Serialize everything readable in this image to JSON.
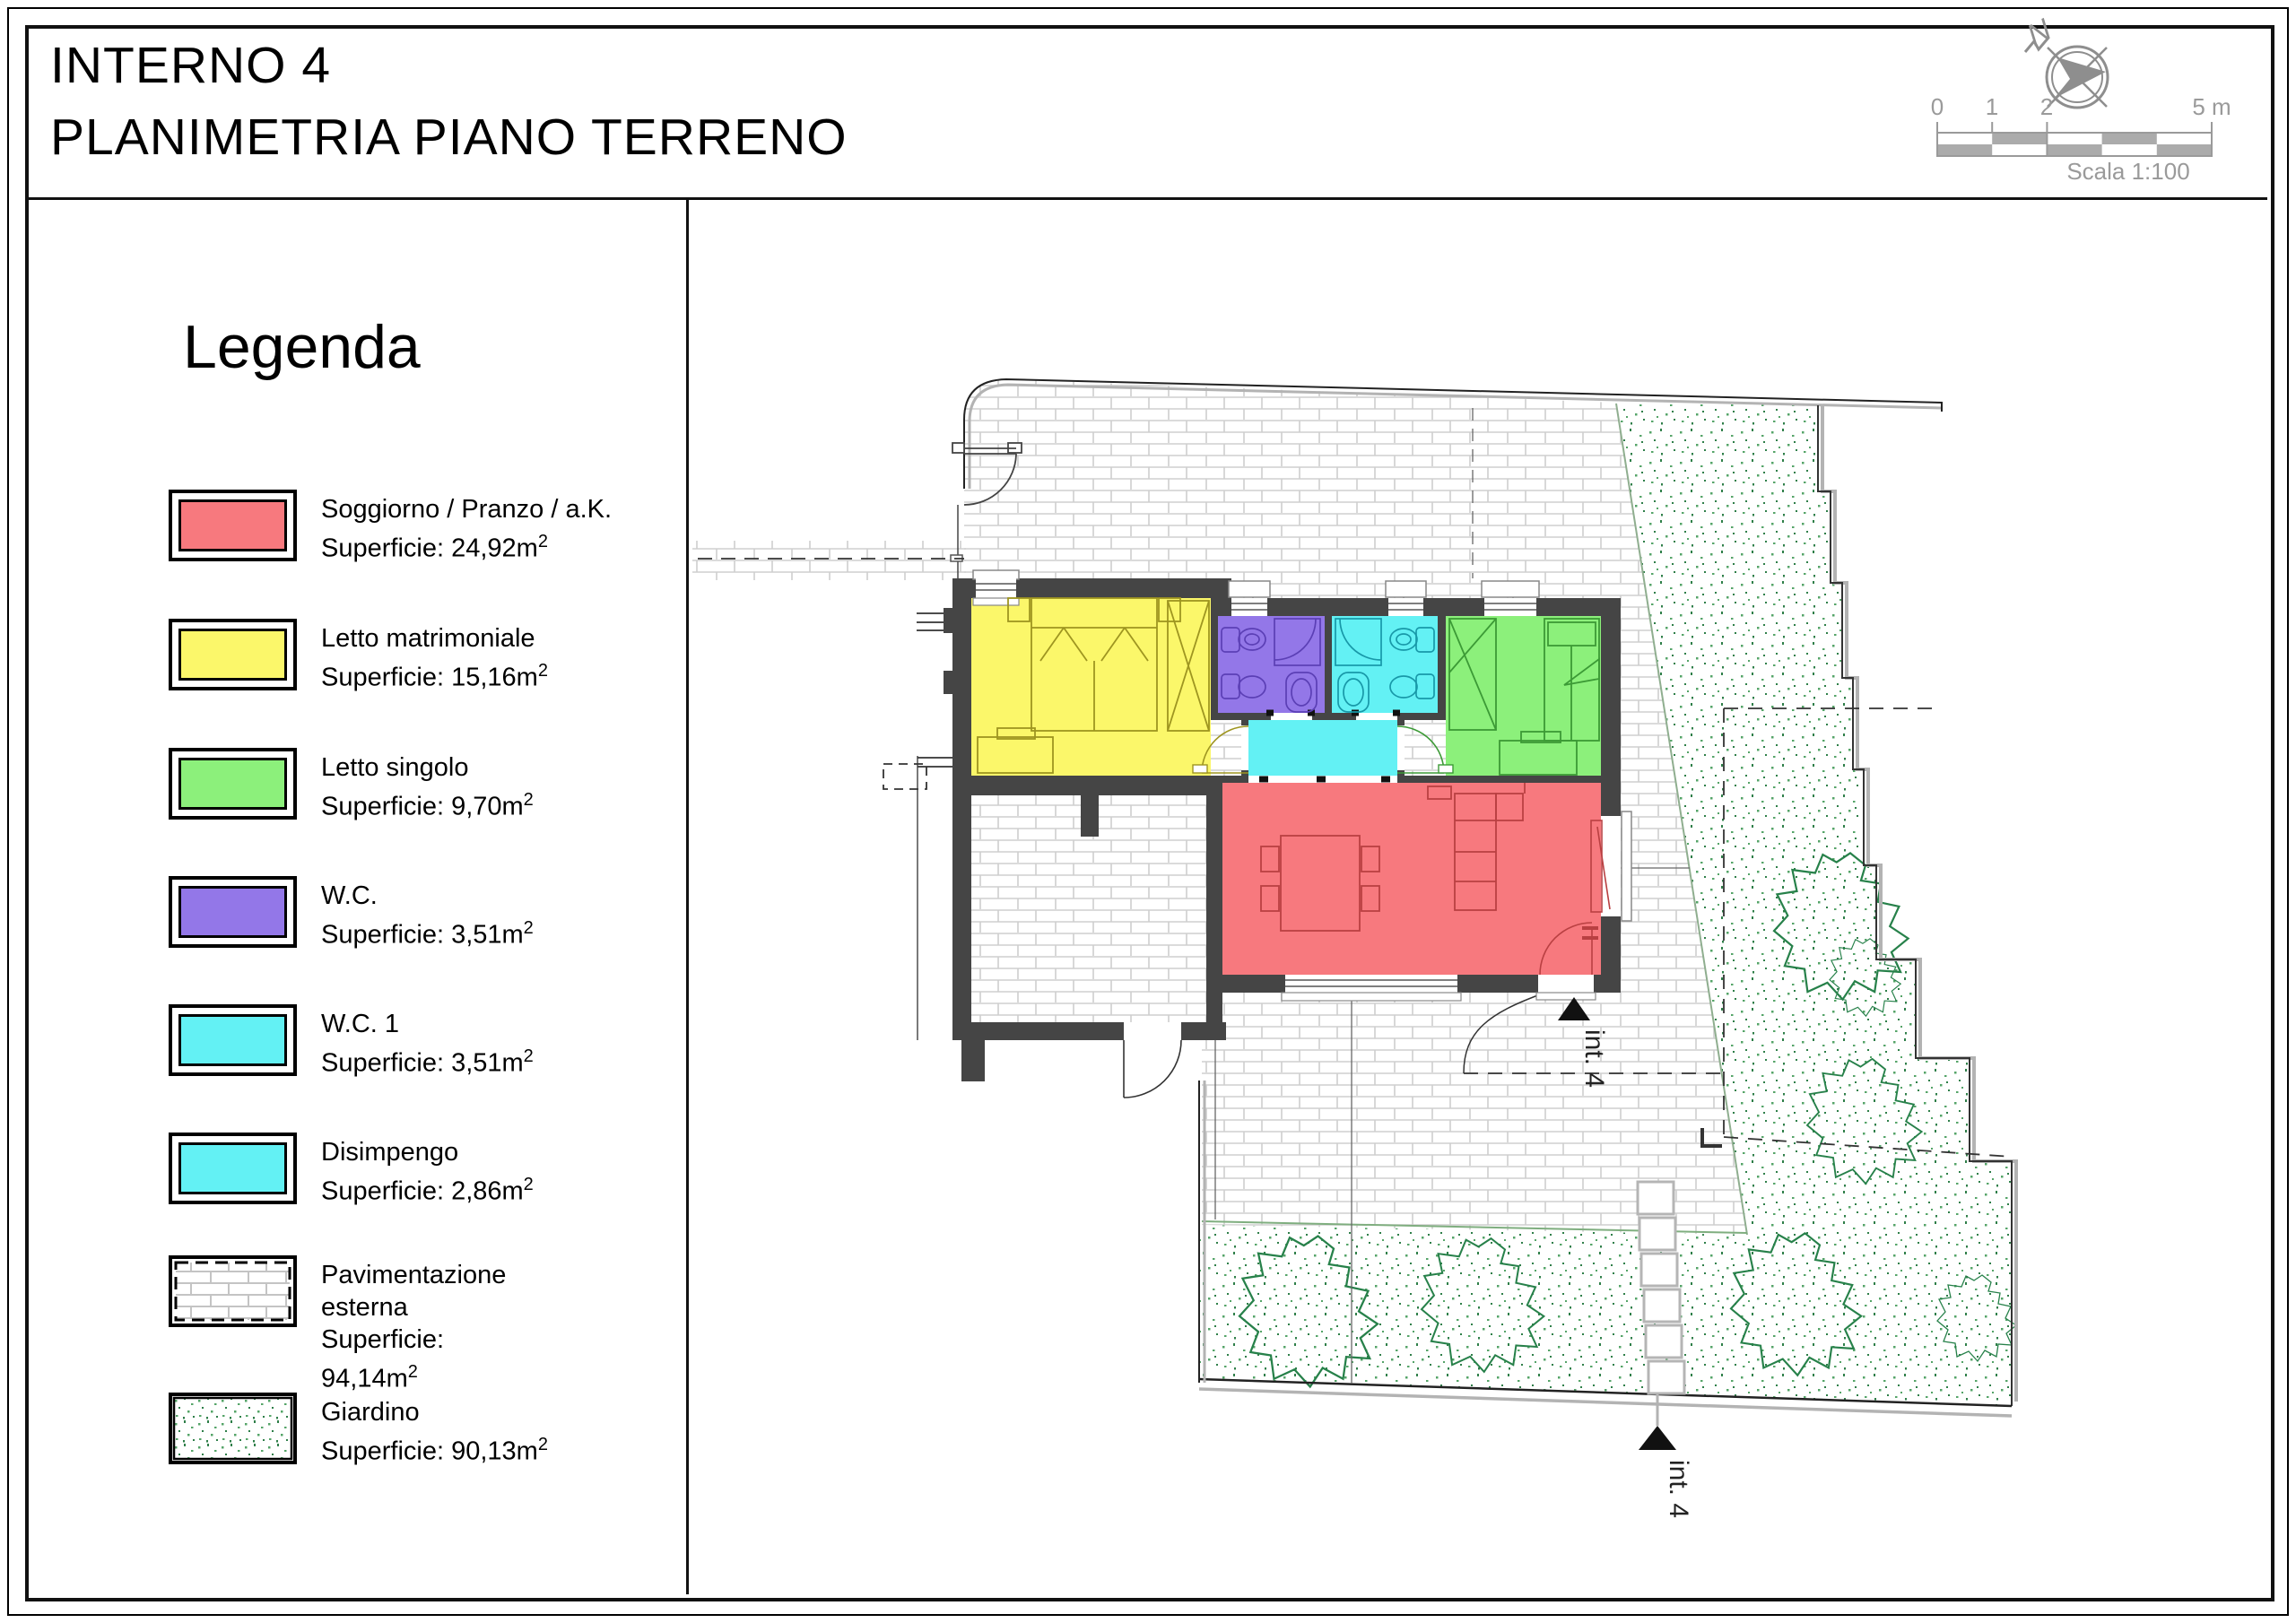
{
  "title": {
    "line1": "INTERNO 4",
    "line2": "PLANIMETRIA PIANO TERRENO"
  },
  "compass": {
    "north_label": "N"
  },
  "scale_bar": {
    "ticks": [
      "0",
      "1",
      "2",
      "5 m"
    ],
    "caption": "Scala 1:100"
  },
  "legend": {
    "heading": "Legenda",
    "superscript": "2",
    "items": [
      {
        "id": "soggiorno",
        "label": "Soggiorno / Pranzo / a.K.",
        "area": "Superficie: 24,92m",
        "color": "#F7797E",
        "swatch": "solid"
      },
      {
        "id": "letto-matrimoniale",
        "label": "Letto matrimoniale",
        "area": "Superficie: 15,16m",
        "color": "#FBF76A",
        "swatch": "solid"
      },
      {
        "id": "letto-singolo",
        "label": "Letto singolo",
        "area": "Superficie: 9,70m",
        "color": "#8CF07B",
        "swatch": "solid"
      },
      {
        "id": "wc",
        "label": "W.C.",
        "area": "Superficie: 3,51m",
        "color": "#9377E8",
        "swatch": "solid"
      },
      {
        "id": "wc-1",
        "label": "W.C. 1",
        "area": "Superficie: 3,51m",
        "color": "#63F1F4",
        "swatch": "solid"
      },
      {
        "id": "disimpengo",
        "label": "Disimpengo",
        "area": "Superficie: 2,86m",
        "color": "#63F1F4",
        "swatch": "solid"
      },
      {
        "id": "pavimentazione",
        "label": "Pavimentazione esterna",
        "area": "Superficie: 94,14m",
        "color": "#ffffff",
        "swatch": "brick"
      },
      {
        "id": "giardino",
        "label": "Giardino",
        "area": "Superficie: 90,13m",
        "color": "#ffffff",
        "swatch": "garden"
      }
    ]
  },
  "plan": {
    "entrance_label": "int. 4",
    "wall_color": "#454545",
    "rooms": {
      "soggiorno": {
        "color": "#F7797E"
      },
      "letto_matrimoniale": {
        "color": "#FBF76A"
      },
      "letto_singolo": {
        "color": "#8CF07B"
      },
      "wc": {
        "color": "#9377E8"
      },
      "wc1": {
        "color": "#63F1F4"
      },
      "disimpengo": {
        "color": "#63F1F4"
      }
    }
  }
}
